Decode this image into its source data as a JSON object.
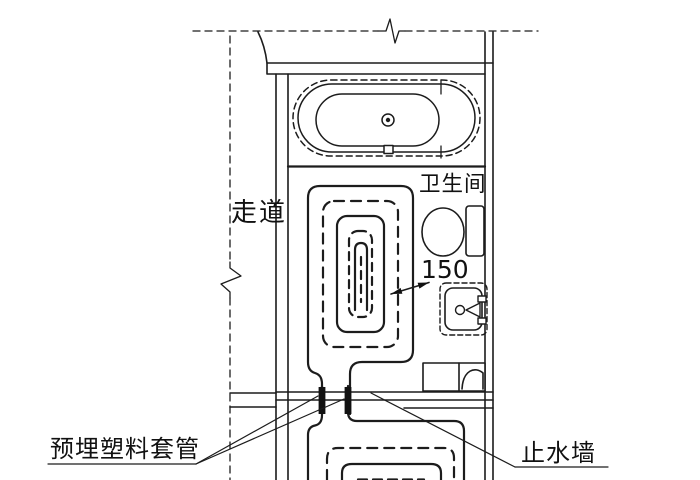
{
  "diagram": {
    "type": "architectural-detail-plan",
    "background_color": "#ffffff",
    "line_color": "#1c1c1c",
    "labels": {
      "corridor": "走道",
      "bathroom": "卫生间",
      "pipe_spacing_value": "150",
      "embedded_sleeve": "预埋塑料套管",
      "water_stop_wall": "止水墙"
    },
    "fixtures": [
      "bathtub",
      "toilet",
      "wash-basin",
      "washing-machine",
      "floor-heating-coil-upper",
      "floor-heating-coil-lower"
    ],
    "notes": "Plan detail of hydronic floor-heating coils in a bathroom unit; two pipes cross the partition wall through pre-embedded plastic sleeves into the room below."
  }
}
